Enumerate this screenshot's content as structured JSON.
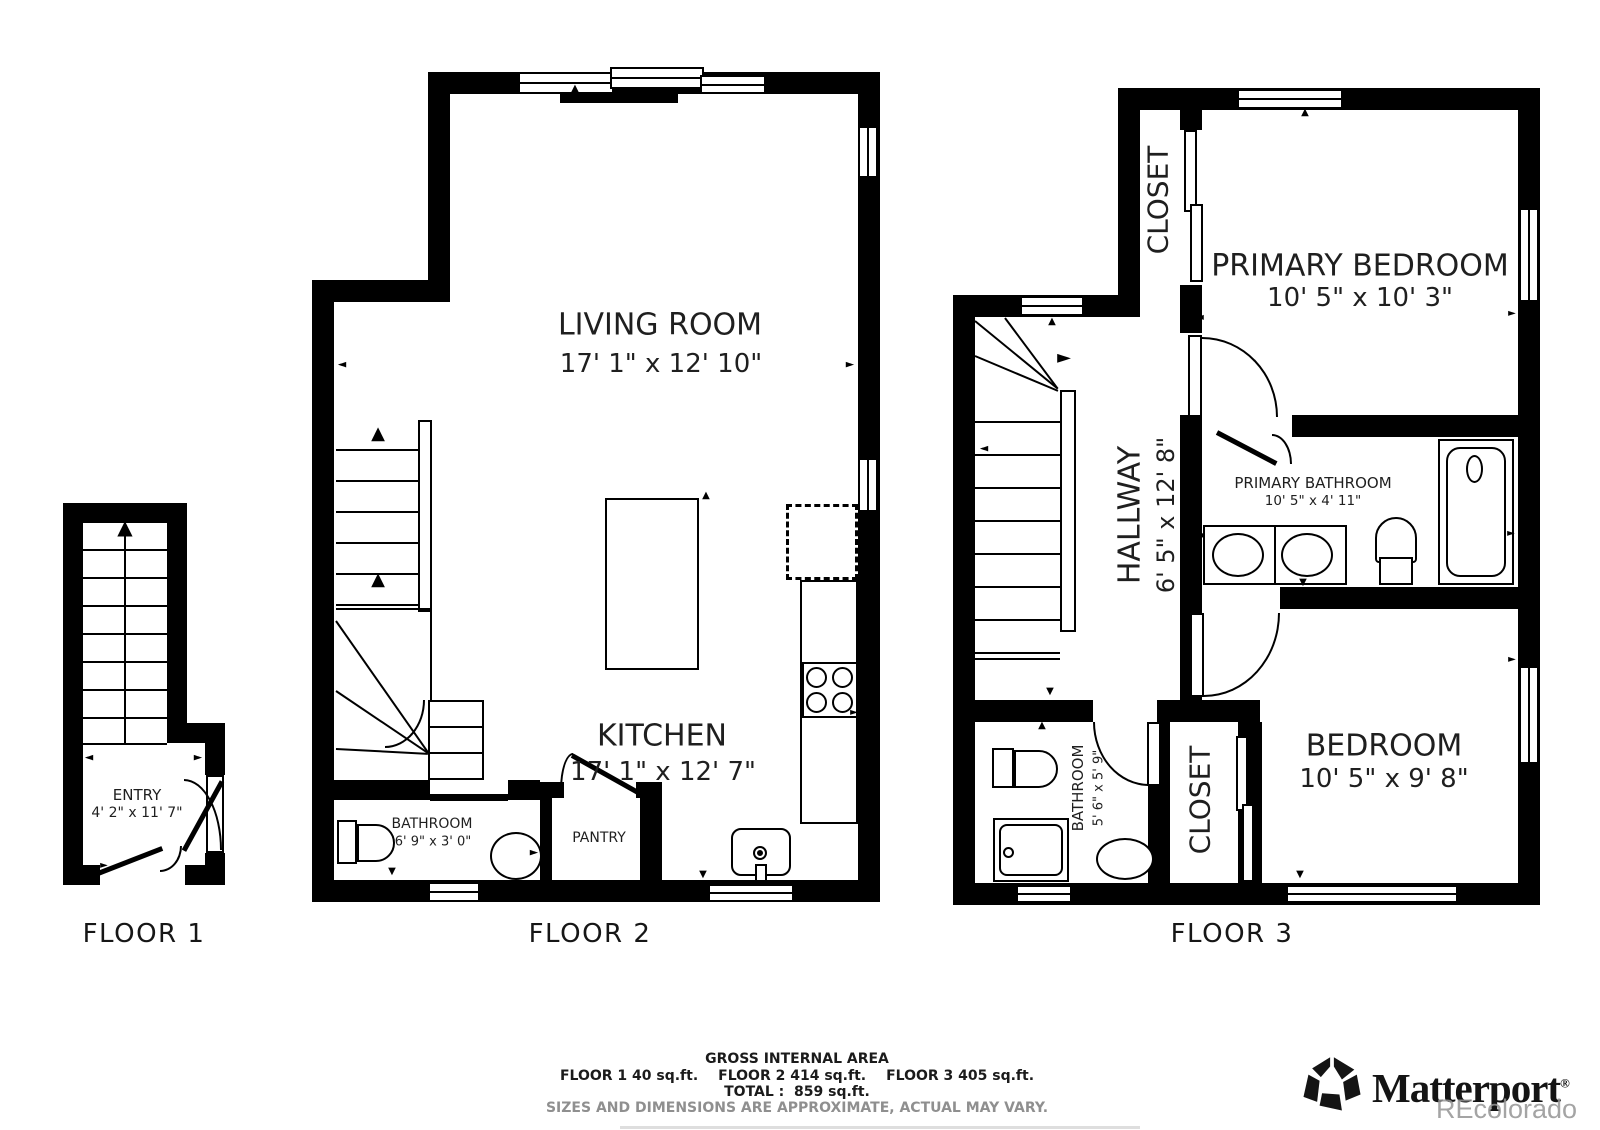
{
  "floor1": {
    "label": "FLOOR 1",
    "rooms": {
      "entry": {
        "name": "ENTRY",
        "dims": "4' 2\" x 11' 7\""
      }
    }
  },
  "floor2": {
    "label": "FLOOR 2",
    "rooms": {
      "living": {
        "name": "LIVING ROOM",
        "dims": "17' 1\" x 12' 10\""
      },
      "kitchen": {
        "name": "KITCHEN",
        "dims": "17' 1\" x 12' 7\""
      },
      "bathroom": {
        "name": "BATHROOM",
        "dims": "6' 9\" x 3' 0\""
      },
      "pantry": {
        "name": "PANTRY"
      }
    }
  },
  "floor3": {
    "label": "FLOOR 3",
    "rooms": {
      "closet_upper": {
        "name": "CLOSET"
      },
      "primary_bedroom": {
        "name": "PRIMARY BEDROOM",
        "dims": "10' 5\" x 10' 3\""
      },
      "hallway": {
        "name": "HALLWAY",
        "dims": "6' 5\" x 12' 8\""
      },
      "primary_bathroom": {
        "name": "PRIMARY BATHROOM",
        "dims": "10' 5\" x 4' 11\""
      },
      "bedroom": {
        "name": "BEDROOM",
        "dims": "10' 5\" x 9' 8\""
      },
      "bathroom": {
        "name": "BATHROOM",
        "dims": "5' 6\" x 5' 9\""
      },
      "closet_lower": {
        "name": "CLOSET"
      }
    }
  },
  "summary": {
    "title": "GROSS INTERNAL AREA",
    "floor1": "FLOOR 1 40 sq.ft.",
    "floor2": "FLOOR 2 414 sq.ft.",
    "floor3": "FLOOR 3 405 sq.ft.",
    "total": "TOTAL :  859 sq.ft.",
    "disclaimer": "SIZES AND DIMENSIONS ARE APPROXIMATE, ACTUAL MAY VARY."
  },
  "branding": {
    "wordmark": "Matterport",
    "registered": "®",
    "watermark": "REcolorado"
  },
  "colors": {
    "wall": "#000000",
    "background": "#ffffff",
    "text": "#1f1f1f",
    "muted": "#8f8f8f",
    "watermark": "#a8a8a8"
  }
}
